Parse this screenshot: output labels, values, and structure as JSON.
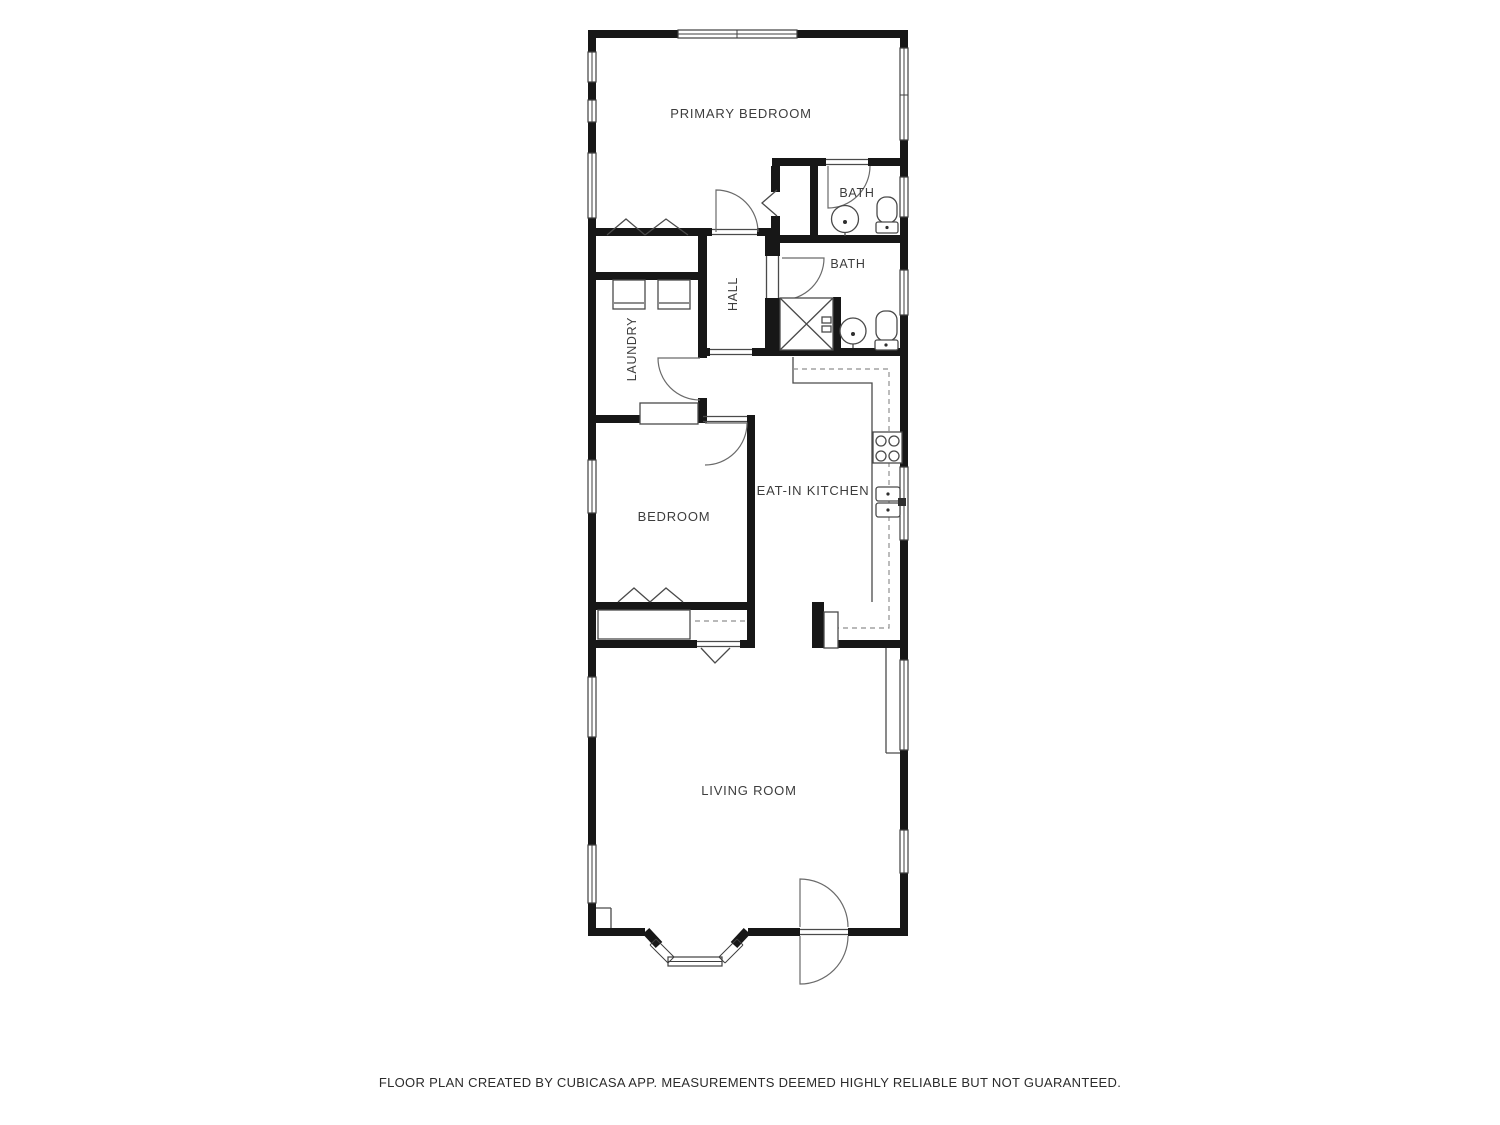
{
  "floor_plan": {
    "rooms": {
      "primary_bedroom": "PRIMARY BEDROOM",
      "bath_top": "BATH",
      "bath_main": "BATH",
      "hall": "HALL",
      "laundry": "LAUNDRY",
      "bedroom": "BEDROOM",
      "kitchen": "EAT-IN KITCHEN",
      "living_room": "LIVING ROOM"
    },
    "footer": "FLOOR PLAN CREATED BY CUBICASA APP. MEASUREMENTS DEEMED HIGHLY RELIABLE BUT NOT GUARANTEED.",
    "colors": {
      "wall": "#171717",
      "line": "#4a4a4a",
      "label": "#3d3d3d",
      "background": "#ffffff"
    }
  }
}
